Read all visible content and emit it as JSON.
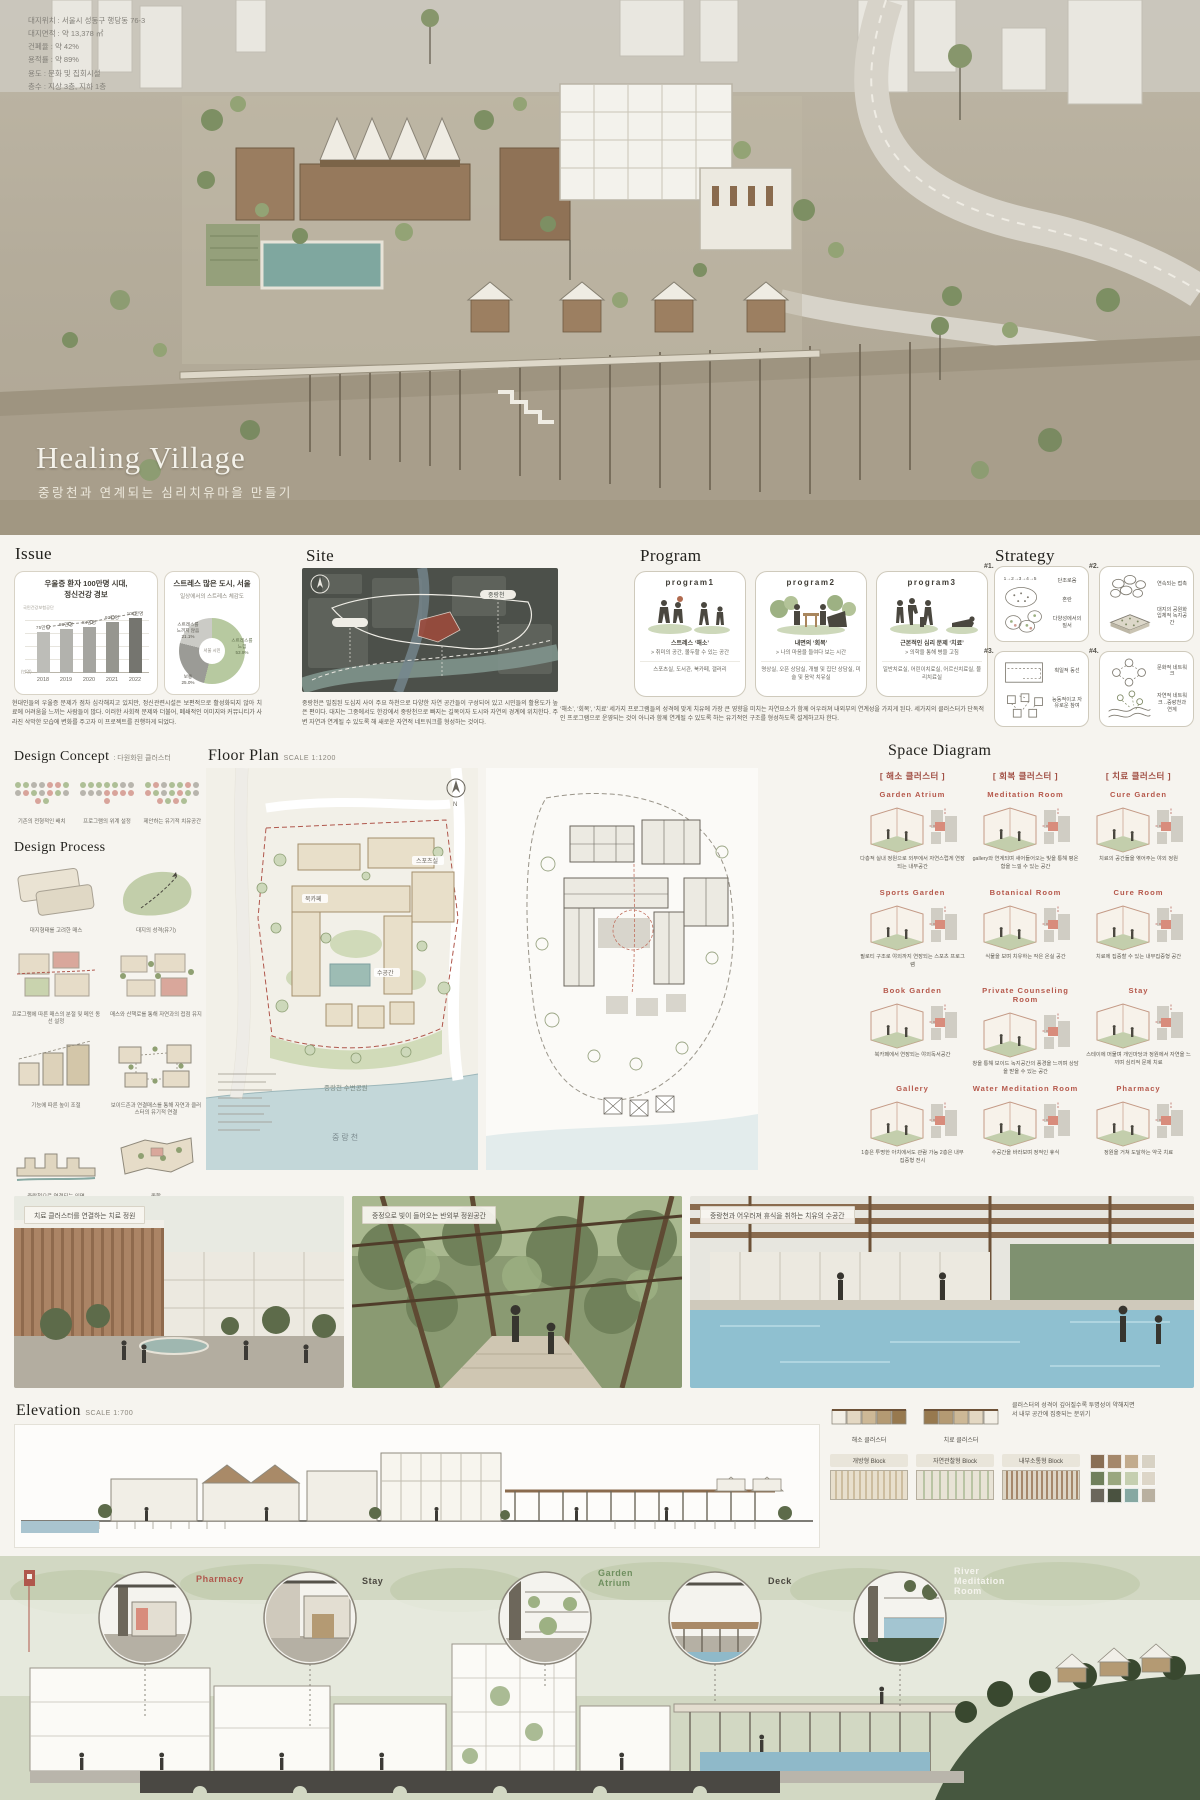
{
  "hero": {
    "title": "Healing Village",
    "subtitle": "중랑천과 연계되는 심리치유마을 만들기",
    "info_lines": [
      "대지위치 :  서울시 성동구 행당동 76-3",
      "대지면적 :  약 13,378 ㎡",
      "건폐율 :  약 42%",
      "용적률 :  약 89%",
      "용도 :  문화 및 집회시설",
      "층수 :  지상 3층, 지하 1층"
    ]
  },
  "issue": {
    "heading": "Issue",
    "body": "현대인들의 우울증 문제가 점차 심각해지고 있지만, 정신관련시설은 보편적으로 활성화되지 않아 치료에 어려움을 느끼는 사람들이 많다. 이러한 사회적 문제와 더불어, 폐쇄적인 이미지와 커뮤니티가 사라진 삭막한 모습에 변화를 주고자 이 프로젝트를 진행하게 되었다.",
    "bar_title": "우울증 환자 100만명 시대,\n정신건강 경보",
    "bar_source": "국민건강보험공단",
    "bar_unit": "(만명)",
    "pie_title": "스트레스 많은 도시, 서울",
    "pie_subtitle": "일상에서의 스트레스 체감도",
    "pie_center": "서울 시민"
  },
  "chart_data": [
    {
      "type": "bar",
      "title": "우울증 환자 100만명 시대, 정신건강 경보",
      "categories": [
        "2018",
        "2019",
        "2020",
        "2021",
        "2022"
      ],
      "values": [
        75,
        80,
        84,
        93,
        100
      ],
      "value_labels": [
        "75만명",
        "80만명",
        "84만명",
        "93만명",
        "100만명"
      ],
      "bar_colors": [
        "#bdbdb8",
        "#b2b2ad",
        "#a5a5a0",
        "#96968f",
        "#75756f"
      ],
      "ylabel": "만명",
      "ylim": [
        0,
        110
      ],
      "grid": true,
      "source": "국민건강보험공단"
    },
    {
      "type": "pie",
      "title": "스트레스 많은 도시, 서울",
      "subtitle": "일상에서의 스트레스 체감도",
      "slices": [
        {
          "label": "스트레스를 느낌",
          "value": 53.9,
          "color": "#b7c9a0"
        },
        {
          "label": "보통",
          "value": 25.0,
          "color": "#9b9b96"
        },
        {
          "label": "스트레스를 느끼지 않음",
          "value": 21.1,
          "color": "#cbcbc6"
        }
      ],
      "center_label": "서울 시민"
    }
  ],
  "pie_labels": {
    "none": "스트레스를\n느끼지 않음\n21.1%",
    "mid": "보통\n25.0%",
    "yes": "스트레스를\n느낌\n53.9%"
  },
  "site": {
    "heading": "Site",
    "map_label": "중랑천",
    "body": "중랑천은 밀집된 도심지 사이 주요 하천으로 다양한 자연 공간들이 구성되어 있고 시민들의 활용도가 높은 편이다. 대지는 그중에서도 한강에서 중랑천으로 빠지는 길목이자 도시와 자연의 경계에 위치한다. 주변 자연과 연계될 수 있도록 해 새로운 자연적 네트워크를 형성하는 것이다."
  },
  "program": {
    "heading": "Program",
    "body": "‘해소’, ‘회복’, ‘치료’ 세가지 프로그램들의 성격에 맞게 치유에 가장 큰 영향을 미치는 자연요소가 함께 어우러져 내외부의 연계성을 가지게 된다. 세가지의 클러스터가 단독적인 프로그램으로 운영되는 것이 아니라 함께 연계될 수 있도록 하는 유기적인 구조를 형성하도록 설계하고자 한다.",
    "cards": [
      {
        "name": "program1",
        "line1": "스트레스 ‘해소’",
        "line2": "> 취미의 공간, 몰두할 수 있는 공간",
        "line3": "스포츠실, 도서관, 북카페, 갤러리"
      },
      {
        "name": "program2",
        "line1": "내면의 ‘회복’",
        "line2": "> 나의 마음을 들여다 보는 시간",
        "line3": "명상실, 오픈 상담실, 개별 및 집단 상담실, 미술 및 음악 치유실"
      },
      {
        "name": "program3",
        "line1": "근본적인 심리 문제 ‘치료’",
        "line2": "> 의학을 통해 병을 고침",
        "line3": "일반치료실, 어린이치료실, 어르신치료실, 물리치료실"
      }
    ]
  },
  "strategy": {
    "heading": "Strategy",
    "items": [
      {
        "num": "#1.",
        "diagram_text": "1 → 2 → 3 → 4 → 5",
        "captions": [
          "단조로움",
          "혼란",
          "다양성에서의 질서"
        ]
      },
      {
        "num": "#2.",
        "diagram_text": "",
        "captions": [
          "연속되는 접촉",
          "대지의 공원화 입체적 녹지공간"
        ]
      },
      {
        "num": "#3.",
        "diagram_text": "",
        "captions": [
          "획일적 동선",
          "능동적이고 자유로운 참여"
        ]
      },
      {
        "num": "#4.",
        "diagram_text": "",
        "captions": [
          "문화적 네트워크",
          "자연적 네트워크 ..중랑천과 연계"
        ]
      }
    ]
  },
  "design_concept": {
    "heading": "Design Concept",
    "suffix": ": 다원화된 클러스터",
    "items": [
      "기존의 전형적인 배치",
      "프로그램의 위계 설정",
      "제안하는 유기적 치유공간"
    ]
  },
  "design_process": {
    "heading": "Design Process",
    "steps": [
      "대지형태를 고려한 매스",
      "대지의 성격(유기)",
      "프로그램에 따른 매스의 분절 및 메인 동선 설정",
      "매스와 산책로를 통해 자연과의 접점 유지",
      "기능에 따른 높이 조절",
      "보이드존과 연결매스를 통해 자연과 클러스터의 유기적 연결",
      "중랑천으로 연결되는 입면",
      "종합"
    ]
  },
  "floor_plan": {
    "heading": "Floor Plan",
    "scale": "SCALE 1:1200",
    "labels": {
      "sports": "스포츠실",
      "water": "수공간",
      "bookcafe": "북카페",
      "park": "중랑천 수변공원",
      "river": "중랑천"
    }
  },
  "space_diagram": {
    "heading": "Space Diagram",
    "clusters": [
      "[ 해소 클러스터 ]",
      "[ 회복 클러스터 ]",
      "[ 치료 클러스터 ]"
    ],
    "cells": [
      {
        "title": "Garden Atrium",
        "caption": "다층적 실내 정원으로 외부에서 자연스럽게 연장되는 내부공간"
      },
      {
        "title": "Meditation Room",
        "caption": "gallery와 연계되며 새어들어오는 빛을 통해 평온함을 느낄 수 있는 공간"
      },
      {
        "title": "Cure Garden",
        "caption": "치료의 공간들을 엮어주는 야외 정원"
      },
      {
        "title": "Sports Garden",
        "caption": "필로티 구조로 야외까지 연장되는 스포츠 프로그램"
      },
      {
        "title": "Botanical Room",
        "caption": "식물을 보며 치유하는 작은 온실 공간"
      },
      {
        "title": "Cure Room",
        "caption": "치료에 집중할 수 있는 내부집중형 공간"
      },
      {
        "title": "Book Garden",
        "caption": "북카페에서 연장되는 야외독서공간"
      },
      {
        "title": "Private Counseling Room",
        "caption": "창을 통해 보이드 녹지공간의 풍경을 느끼며 상담을 받을 수 있는 공간"
      },
      {
        "title": "Stay",
        "caption": "스테이에 머물며 개인마당과 정원에서 자연을 느끼며 심리적 문제 치료"
      },
      {
        "title": "Gallery",
        "caption": "1층은 투명한 아치에서도 관람 가능 2층은 내부 집중형 전시"
      },
      {
        "title": "Water Meditation Room",
        "caption": "수공간을 바라보며 정적인 휴식"
      },
      {
        "title": "Pharmacy",
        "caption": "정원을 거쳐 도달하는 약국 치료"
      }
    ]
  },
  "renders": [
    {
      "caption": "치료 클러스터를 연결하는 치료 정원"
    },
    {
      "caption": "중정으로 빛이 들어오는 반외부 정원공간"
    },
    {
      "caption": "중랑천과 어우러져 휴식을 취하는 치유의 수공간"
    }
  ],
  "elevation": {
    "heading": "Elevation",
    "scale": "SCALE 1:700",
    "mini_labels": [
      "해소 클러스터",
      "치료 클러스터"
    ],
    "caption": "클러스터의 성격이 깊어질수록 투명성이 약해지면서 내부 공간에 집중되는 분위기",
    "blocks": [
      "개방형 Block",
      "자연관찰형 Block",
      "내부소통형 Block"
    ],
    "materials": [
      "#8a6f55",
      "#a5886b",
      "#c2ab8d",
      "#d8d2c4",
      "#70805c",
      "#9aa77f",
      "#c5cfb0",
      "#ddd6c8",
      "#6b665c",
      "#4a5240",
      "#86a8a2",
      "#b9b0a0"
    ]
  },
  "bottom": {
    "callouts": [
      {
        "label": "Pharmacy",
        "color": "#b0574c"
      },
      {
        "label": "Stay",
        "color": "#4a473f"
      },
      {
        "label": "Garden\nAtrium",
        "color": "#6f8f5f"
      },
      {
        "label": "Deck",
        "color": "#4a473f"
      },
      {
        "label": "River\nMeditation\nRoom",
        "color": "#f5f4ee"
      }
    ]
  },
  "colors": {
    "accent_red": "#b0574c",
    "accent_green": "#b7c9a0",
    "paper": "#f6f4ef"
  }
}
